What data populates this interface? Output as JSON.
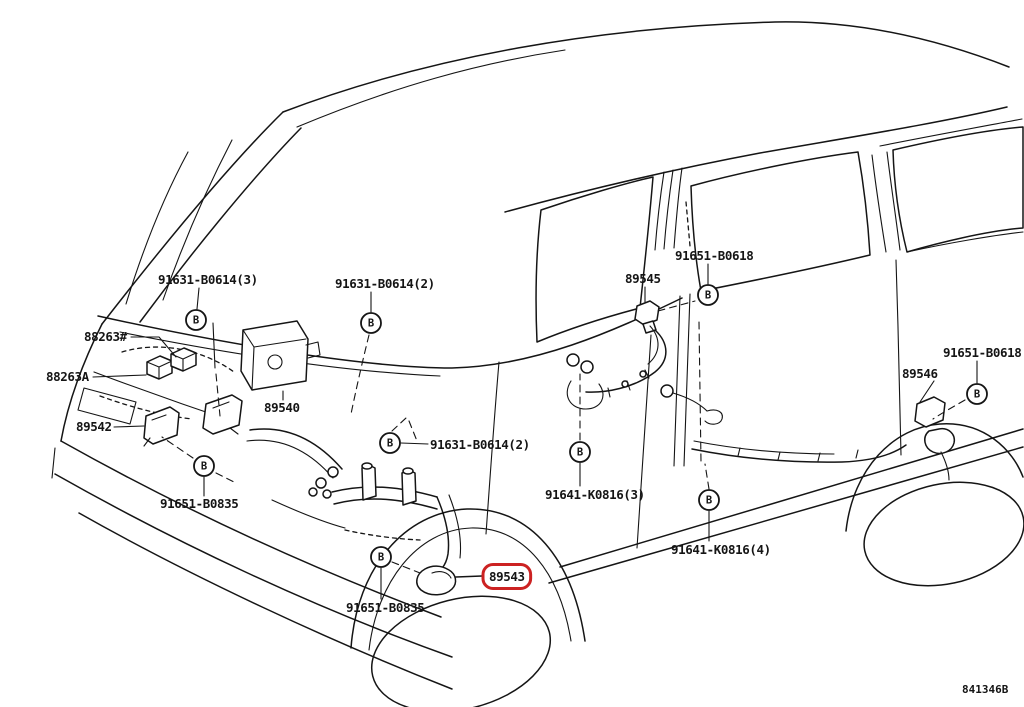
{
  "diagram": {
    "title_hint": "vehicle skid control sensor parts diagram",
    "code": "841346B",
    "callout_letter": "B",
    "colors": {
      "line": "#151515",
      "highlight": "#cc2222",
      "background": "#ffffff"
    },
    "highlighted_part": "89543",
    "callouts": [
      {
        "x": 196,
        "y": 320
      },
      {
        "x": 371,
        "y": 323
      },
      {
        "x": 204,
        "y": 466
      },
      {
        "x": 390,
        "y": 443
      },
      {
        "x": 381,
        "y": 557
      },
      {
        "x": 580,
        "y": 452
      },
      {
        "x": 708,
        "y": 295
      },
      {
        "x": 709,
        "y": 500
      },
      {
        "x": 977,
        "y": 394
      }
    ],
    "labels": [
      {
        "text": "91631-B0614(3)",
        "x": 158,
        "y": 284,
        "highlighted": false
      },
      {
        "text": "91631-B0614(2)",
        "x": 335,
        "y": 288,
        "highlighted": false
      },
      {
        "text": "88263#",
        "x": 84,
        "y": 341,
        "highlighted": false
      },
      {
        "text": "88263A",
        "x": 46,
        "y": 381,
        "highlighted": false
      },
      {
        "text": "89540",
        "x": 264,
        "y": 412,
        "highlighted": false
      },
      {
        "text": "89542",
        "x": 76,
        "y": 431,
        "highlighted": false
      },
      {
        "text": "91651-B0835",
        "x": 160,
        "y": 508,
        "highlighted": false
      },
      {
        "text": "91631-B0614(2)",
        "x": 430,
        "y": 449,
        "highlighted": false
      },
      {
        "text": "89543",
        "x": 489,
        "y": 581,
        "highlighted": true
      },
      {
        "text": "91651-B0835",
        "x": 346,
        "y": 612,
        "highlighted": false
      },
      {
        "text": "89545",
        "x": 625,
        "y": 283,
        "highlighted": false
      },
      {
        "text": "91651-B0618",
        "x": 675,
        "y": 260,
        "highlighted": false
      },
      {
        "text": "91641-K0816(3)",
        "x": 545,
        "y": 499,
        "highlighted": false
      },
      {
        "text": "91641-K0816(4)",
        "x": 671,
        "y": 554,
        "highlighted": false
      },
      {
        "text": "89546",
        "x": 902,
        "y": 378,
        "highlighted": false
      },
      {
        "text": "91651-B0618",
        "x": 943,
        "y": 357,
        "highlighted": false
      }
    ]
  }
}
